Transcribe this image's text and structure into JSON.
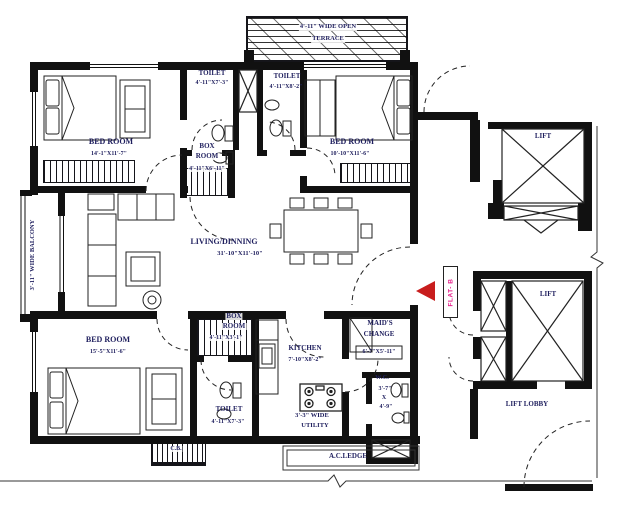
{
  "colors": {
    "ink": "#111111",
    "text": "#1f1f5e",
    "flat_label": "#e6218c",
    "entry_arrow": "#c81d1d"
  },
  "rooms": {
    "terrace": {
      "line1": "4'-11\" WIDE OPEN",
      "line2": "TERRACE"
    },
    "toilet_top_left": {
      "name": "TOILET",
      "dims": "4'-11\"X7'-3\""
    },
    "toilet_top_right": {
      "name": "TOILET",
      "dims": "4'-11\"X8'-2\""
    },
    "bedroom_top_left": {
      "name": "BED ROOM",
      "dims": "14'-1\"X11'-7\""
    },
    "bedroom_top_right": {
      "name": "BED ROOM",
      "dims": "10'-10\"X11'-6\""
    },
    "box_room_upper": {
      "line1": "BOX",
      "line2": "ROOM",
      "dims": "4'-11\"X6'-11\""
    },
    "living_dining": {
      "name": "LIVING/DINNING",
      "dims": "31'-10\"X11'-10\""
    },
    "balcony": {
      "name": "3'-11\" WIDE BALCONY"
    },
    "bedroom_bottom": {
      "name": "BED ROOM",
      "dims": "15'-5\"X11'-6\""
    },
    "box_room_lower": {
      "line1": "BOX",
      "line2": "ROOM",
      "dims": "4'-11\"X3'-1\""
    },
    "toilet_bottom": {
      "name": "TOILET",
      "dims": "4'-11\"X7'-3\""
    },
    "kitchen": {
      "name": "KITCHEN",
      "dims": "7'-10\"X8'-2\""
    },
    "utility": {
      "line1": "3'-3\" WIDE",
      "line2": "UTILITY"
    },
    "maids_change": {
      "line1": "MAID'S",
      "line2": "CHANGE",
      "dims": "6'-7\"X5'-11\""
    },
    "wc": {
      "name": "W.C.",
      "dim_w": "3'-7\"",
      "dim_sep": "X",
      "dim_h": "4'-9\""
    },
    "lift_top": {
      "name": "LIFT"
    },
    "lift_middle": {
      "name": "LIFT"
    },
    "lift_lobby": {
      "name": "LIFT LOBBY"
    },
    "ac_ledge": {
      "name": "A.C.LEDGE"
    },
    "cupboard": {
      "name": "C.B."
    }
  },
  "markers": {
    "flat": "FLAT- B"
  }
}
